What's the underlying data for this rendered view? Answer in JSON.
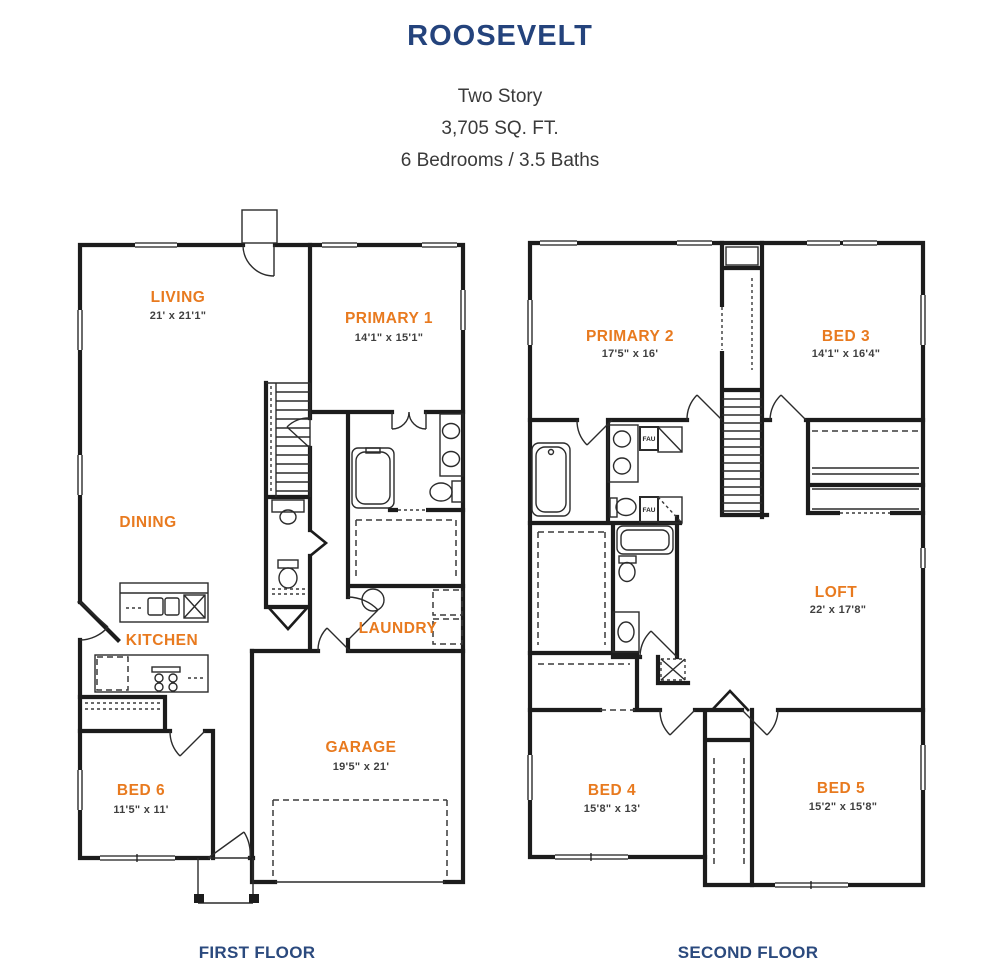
{
  "header": {
    "title": "ROOSEVELT",
    "details": [
      "Two Story",
      "3,705 SQ. FT.",
      "6 Bedrooms / 3.5 Baths"
    ]
  },
  "floors": {
    "first": {
      "caption": "FIRST FLOOR",
      "rooms": [
        {
          "name": "LIVING",
          "dims": "21' x 21'1\""
        },
        {
          "name": "PRIMARY 1",
          "dims": "14'1\" x 15'1\""
        },
        {
          "name": "DINING",
          "dims": ""
        },
        {
          "name": "KITCHEN",
          "dims": ""
        },
        {
          "name": "LAUNDRY",
          "dims": ""
        },
        {
          "name": "BED 6",
          "dims": "11'5\" x 11'"
        },
        {
          "name": "GARAGE",
          "dims": "19'5\" x 21'"
        }
      ]
    },
    "second": {
      "caption": "SECOND FLOOR",
      "rooms": [
        {
          "name": "PRIMARY 2",
          "dims": "17'5\" x 16'"
        },
        {
          "name": "BED 3",
          "dims": "14'1\" x 16'4\""
        },
        {
          "name": "LOFT",
          "dims": "22' x 17'8\""
        },
        {
          "name": "BED 4",
          "dims": "15'8\" x 13'"
        },
        {
          "name": "BED 5",
          "dims": "15'2\" x 15'8\""
        }
      ],
      "labels": {
        "fau": "FAU"
      }
    }
  },
  "colors": {
    "title_navy": "#24437C",
    "caption_navy": "#2B4A7E",
    "room_orange": "#E87A1F",
    "dims_gray": "#3F3F3F",
    "wall_black": "#1C1C1C",
    "background": "#FFFFFF"
  }
}
